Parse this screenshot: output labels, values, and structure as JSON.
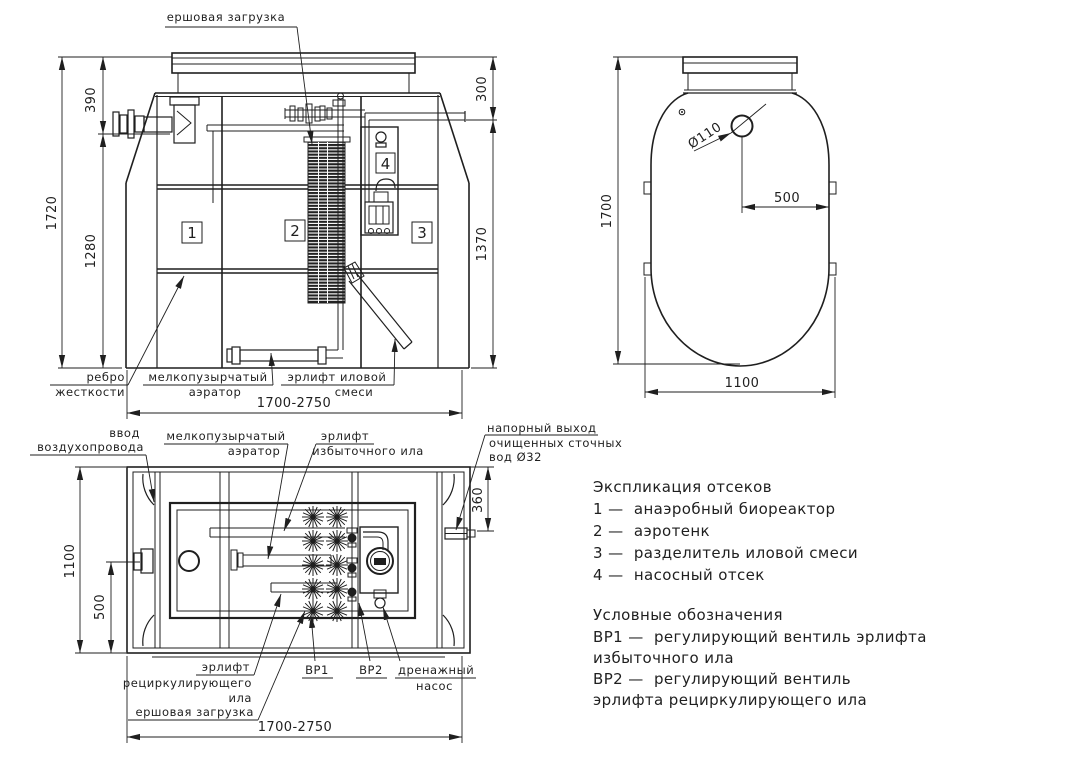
{
  "colors": {
    "ink": "#1f1f1f",
    "paper": "#ffffff"
  },
  "front_view": {
    "callouts": {
      "brush_load": "ершовая загрузка",
      "rib_l1": "ребро",
      "rib_l2": "жесткости",
      "aerator_l1": "мелкопузырчатый",
      "aerator_l2": "аэратор",
      "airlift_l1": "эрлифт иловой",
      "airlift_l2": "смеси"
    },
    "dims": {
      "total_height": "1720",
      "top": "390",
      "mid": "1280",
      "right_top": "300",
      "right": "1370",
      "length": "1700-2750"
    },
    "compartments": [
      "1",
      "2",
      "3",
      "4"
    ]
  },
  "side_view": {
    "hole_dia": "Ø110",
    "dims": {
      "height": "1700",
      "hole_offset": "500",
      "width": "1100"
    }
  },
  "plan_view": {
    "callouts": {
      "air_l1": "ввод",
      "air_l2": "воздухопровода",
      "aerator_l1": "мелкопузырчатый",
      "aerator_l2": "аэратор",
      "excess_l1": "эрлифт",
      "excess_l2": "избыточного ила",
      "outlet_l1": "напорный выход",
      "outlet_l2": "очищенных сточных",
      "outlet_l3": "вод Ø32",
      "recirc_l1": "эрлифт",
      "recirc_l2": "рециркулирующего",
      "recirc_l3": "ила",
      "brush": "ершовая загрузка",
      "vr1": "ВР1",
      "vr2": "ВР2",
      "drain_l1": "дренажный",
      "drain_l2": "насос"
    },
    "dims": {
      "width": "1100",
      "port": "500",
      "outlet": "360",
      "length": "1700-2750"
    }
  },
  "legend": {
    "compartments_title": "Экспликация отсеков",
    "compartment_items": [
      "1 —  анаэробный биореактор",
      "2 —  аэротенк",
      "3 —  разделитель иловой смеси",
      "4 —  насосный отсек"
    ],
    "symbols_title": "Условные обозначения",
    "symbol_lines": [
      "ВР1 —  регулирующий вентиль эрлифта",
      "избыточного ила",
      "ВР2 —  регулирующий вентиль",
      "эрлифта рециркулирующего ила"
    ]
  }
}
